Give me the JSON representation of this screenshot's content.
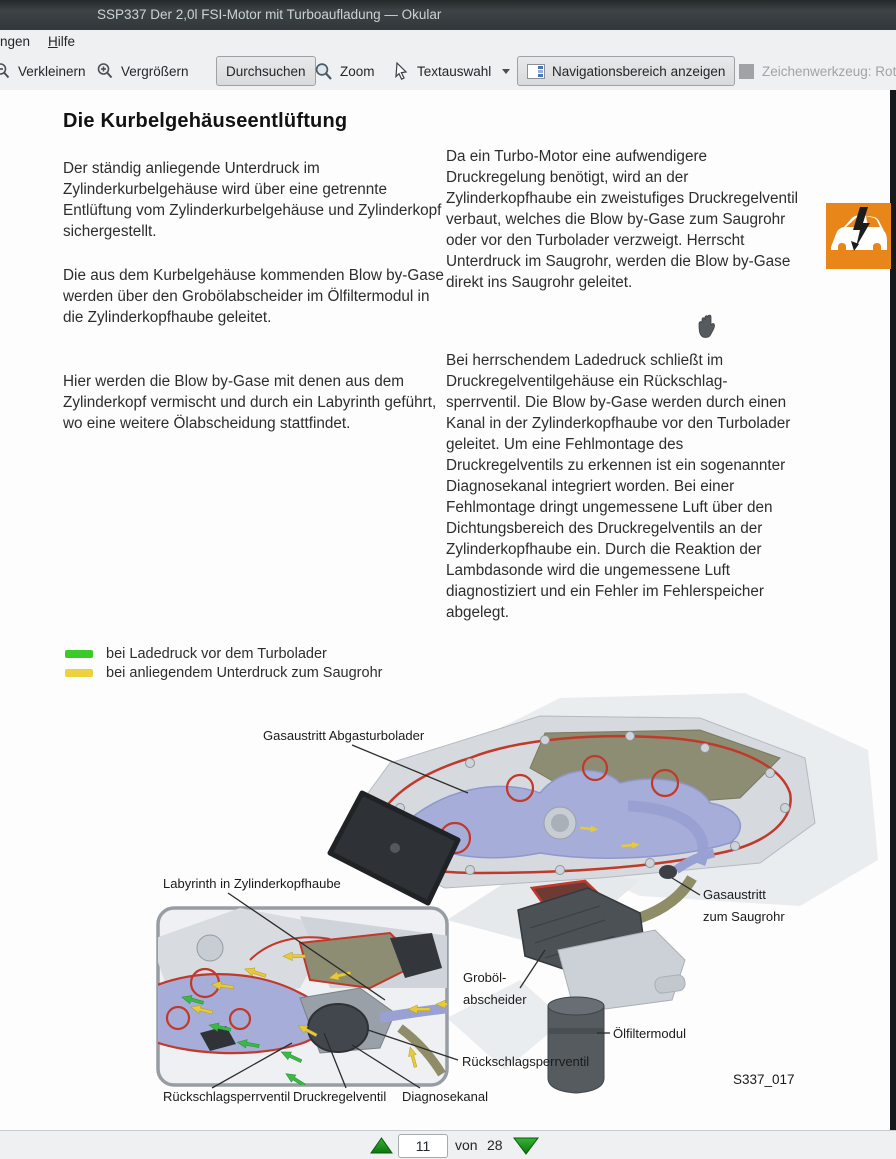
{
  "window": {
    "title": "SSP337 Der 2,0l FSI-Motor mit Turboaufladung — Okular"
  },
  "menubar": {
    "settings_partial": "ngen",
    "help_accel": "H",
    "help_rest": "ilfe"
  },
  "toolbar": {
    "zoom_out_label": "Verkleinern",
    "zoom_in_label": "Vergrößern",
    "browse_label": "Durchsuchen",
    "zoom_label": "Zoom",
    "text_select_label": "Textauswahl",
    "nav_panel_label": "Navigationsbereich anzeigen",
    "draw_tool_label": "Zeichenwerkzeug: Rot"
  },
  "document": {
    "heading": "Die Kurbelgehäuseentlüftung",
    "left_column": [
      "Der ständig anliegende Unterdruck im Zylinderkurbelgehäuse wird über eine getrennte Entlüftung vom Zylinderkurbelgehäuse und Zylinderkopf sichergestellt.",
      "Die aus dem Kurbelgehäuse kommenden Blow by-Gase werden über den Grobölabscheider im Ölfiltermodul in die Zylinderkopfhaube geleitet.",
      "Hier werden die Blow by-Gase mit denen aus dem Zylinderkopf vermischt und durch ein Labyrinth geführt, wo eine weitere Ölabscheidung stattfindet."
    ],
    "right_column": [
      "Da ein Turbo-Motor eine aufwendigere Druckregelung benötigt, wird an der Zylinderkopfhaube ein zweistufiges Druckregelventil verbaut, welches die Blow by-Gase zum Saugrohr oder vor den Turbolader verzweigt. Herrscht Unterdruck im Saugrohr, werden die Blow by-Gase direkt ins Saugrohr geleitet.",
      "Bei herrschendem Ladedruck schließt im Druckregelventilgehäuse ein Rückschlag-sperrventil. Die Blow by-Gase werden durch einen Kanal in der Zylinderkopfhaube vor den Turbolader geleitet. Um eine Fehlmontage des Druckregelventils zu erkennen ist ein sogenannter Diagnosekanal integriert worden. Bei einer Fehlmontage dringt ungemessene Luft über den Dichtungsbereich des Druckregelventils an der Zylinderkopfhaube ein. Durch die Reaktion der Lambdasonde wird die ungemessene Luft diagnostiziert und ein Fehler im Fehlerspeicher abgelegt."
    ],
    "legend": {
      "items": [
        {
          "color": "#3bcb28",
          "label": "bei Ladedruck vor dem Turbolader"
        },
        {
          "color": "#ecd23c",
          "label": "bei anliegendem Unterdruck zum Saugrohr"
        }
      ]
    },
    "figure": {
      "labels": {
        "gas_outlet_turbo": "Gasaustritt Abgasturbolader",
        "labyrinth": "Labyrinth in Zylinderkopfhaube",
        "check_valve_left": "Rückschlagsperrventil",
        "pressure_valve": "Druckregelventil",
        "diagnostic_channel": "Diagnosekanal",
        "check_valve_right": "Rückschlagsperrventil",
        "oil_separator": [
          "Groböl-",
          "abscheider"
        ],
        "oil_filter_module": "Ölfiltermodul",
        "gas_outlet_intake": [
          "Gasaustritt",
          "zum Saugrohr"
        ]
      },
      "figure_id": "S337_017"
    }
  },
  "statusbar": {
    "current_page": "11",
    "of_label": "von",
    "total_pages": "28"
  },
  "colors": {
    "legend_green": "#3bcb28",
    "legend_yellow": "#ecd23c",
    "warning_icon_orange": "#e8861a",
    "nav_arrow_green": "#1d9b1d"
  }
}
